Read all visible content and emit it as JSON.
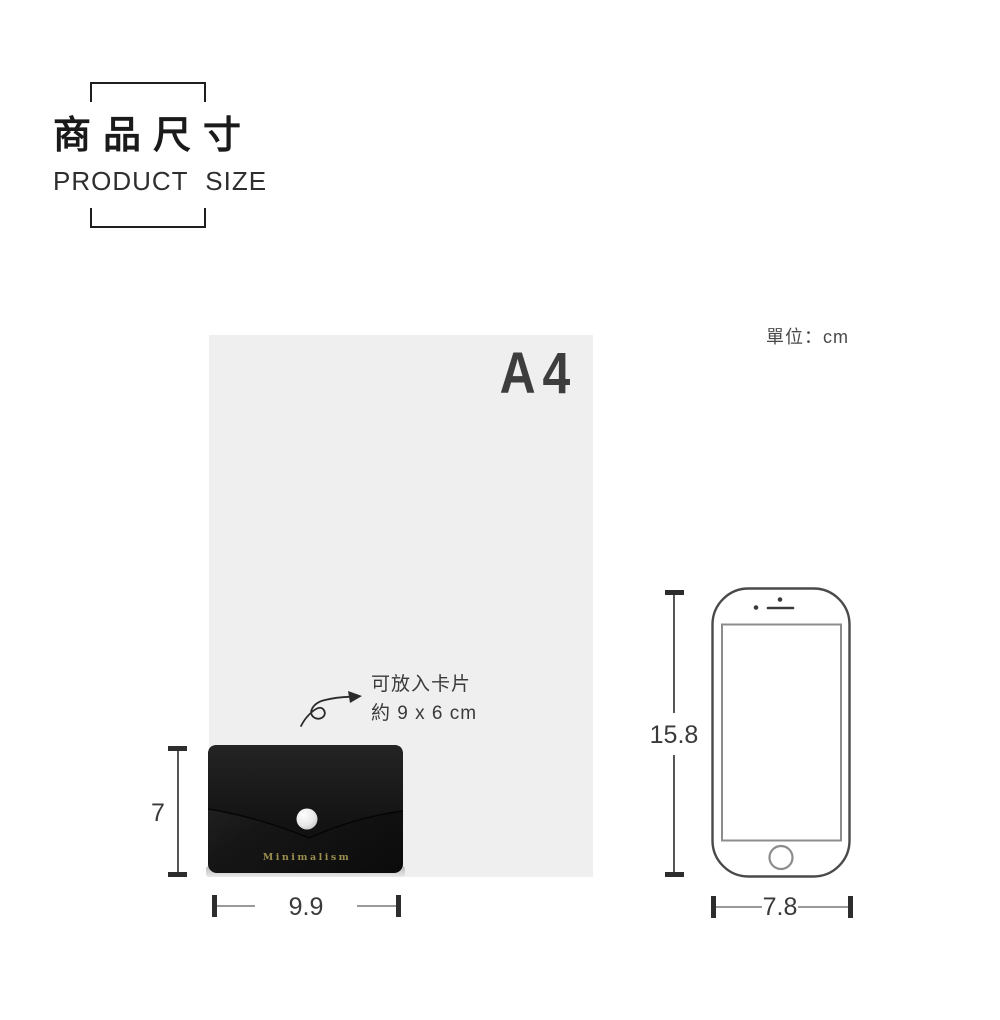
{
  "header": {
    "title_zh": "商品尺寸",
    "title_en": "PRODUCT SIZE"
  },
  "unit_label": "單位：cm",
  "a4_sheet": {
    "label": "A4"
  },
  "card_note": {
    "line1": "可放入卡片",
    "line2": "約 9 x 6 cm"
  },
  "wallet": {
    "brand": "Minimalism",
    "height_cm": "7",
    "width_cm": "9.9"
  },
  "phone": {
    "height_cm": "15.8",
    "width_cm": "7.8"
  },
  "colors": {
    "ink": "#1f1f1f",
    "a4_gray": "#efefef",
    "a4_label_gray": "#3d3d3d",
    "dim_text": "#3a3a3a",
    "dim_cap": "#2d2d2d",
    "wallet_black": "#141414",
    "brand_gold": "#9c8e4e",
    "phone_outline": "#4a4a4a",
    "phone_detail": "#8c8c8c"
  }
}
